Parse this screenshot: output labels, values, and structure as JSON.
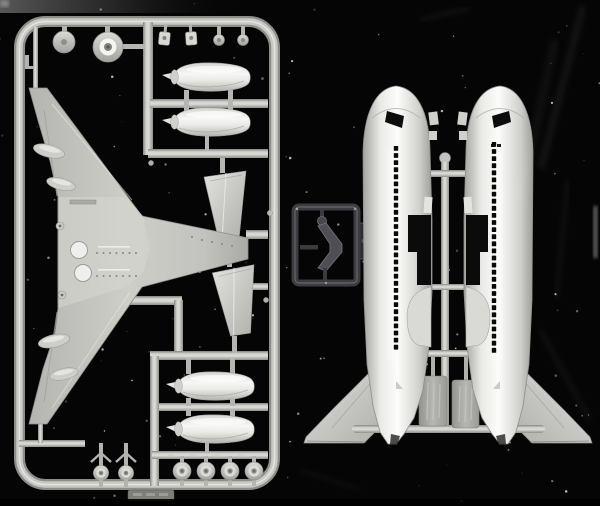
{
  "meta": {
    "title": "Scanned photograph of airliner model kit sprues on a black background",
    "media": "scanned photograph",
    "image_width": 600,
    "image_height": 506
  },
  "palette": {
    "background": "#050505",
    "sprue_gray": "#b9b9b5",
    "runner_light": "#d6d6d2",
    "runner_dark": "#8a8a86",
    "part_white": "#f3f3f1",
    "fuselage_white": "#efefed",
    "plate_gray": "#a4a4a0",
    "clear_frame": "#3b3b40",
    "clear_part": "#505056",
    "window_black": "#0a0a0a",
    "smear_gray": "#6a6a6a"
  },
  "main_sprue": {
    "name": "gray parts sprue",
    "parts": [
      {
        "name": "one-piece lower wing",
        "qty": 1
      },
      {
        "name": "engine nacelle half",
        "qty": 4
      },
      {
        "name": "horizontal stabilizer",
        "qty": 2
      },
      {
        "name": "main wheel",
        "qty": 4
      },
      {
        "name": "landing gear leg with wheel",
        "qty": 2
      },
      {
        "name": "wheel disc",
        "qty": 1
      },
      {
        "name": "fan hub disc",
        "qty": 1
      },
      {
        "name": "gear door bracket",
        "qty": 2
      },
      {
        "name": "small hub",
        "qty": 2
      },
      {
        "name": "antenna mast",
        "qty": 1
      }
    ],
    "molded_tag_text": "illegible embossed part number"
  },
  "fuselage_sprue": {
    "name": "fuselage halves with tail fins",
    "halves": 2,
    "window_rows": {
      "left": {
        "x": 396,
        "y_start": 146,
        "count": 29,
        "spacing": 7.1,
        "size": 4.4
      },
      "right": {
        "x": 494,
        "y_start": 142,
        "count": 30,
        "spacing": 7.1,
        "size": 4.4
      }
    },
    "features": [
      "black cockpit window opening",
      "wing root cutout",
      "outward-swept tail fin",
      "black tail slot",
      "embossed runner plates"
    ]
  },
  "clear_sprue": {
    "name": "clear parts frame",
    "parts": [
      {
        "name": "cockpit glazing chevron",
        "qty": 1
      }
    ]
  },
  "landing": {
    "main_wheels": {
      "cx": [
        182,
        206,
        230,
        254
      ],
      "cy": 471,
      "r": 9
    },
    "gear_legs": {
      "cx": [
        101,
        126
      ],
      "cy": 473
    }
  },
  "speckles": {
    "count": 150,
    "seed": 987654321
  },
  "scratches": [
    {
      "x1": 583,
      "y1": 6,
      "x2": 541,
      "y2": 168,
      "w": 7,
      "o": 0.06
    },
    {
      "x1": 568,
      "y1": 180,
      "x2": 556,
      "y2": 300,
      "w": 4,
      "o": 0.05
    },
    {
      "x1": 420,
      "y1": 20,
      "x2": 470,
      "y2": 8,
      "w": 3,
      "o": 0.07
    },
    {
      "x1": 300,
      "y1": 470,
      "x2": 360,
      "y2": 490,
      "w": 3,
      "o": 0.05
    },
    {
      "x1": 540,
      "y1": 330,
      "x2": 590,
      "y2": 420,
      "w": 5,
      "o": 0.045
    },
    {
      "x1": 555,
      "y1": 40,
      "x2": 520,
      "y2": 200,
      "w": 9,
      "o": 0.04
    }
  ]
}
